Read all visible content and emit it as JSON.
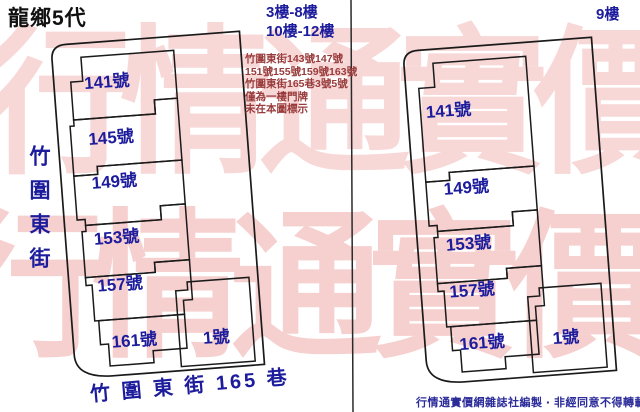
{
  "title": "龍鄉5代",
  "watermark": {
    "text": "行情通實價網",
    "color": "#f8d7d7"
  },
  "colors": {
    "label_navy": "#1c1c9c",
    "note_red": "#993b3b",
    "outline_black": "#1a1a1a",
    "credit_blue": "#2b2b9a"
  },
  "left_map": {
    "floors_line1": "3樓-8樓",
    "floors_line2": "10樓-12樓",
    "street_left_vertical": "竹圍東街",
    "street_bottom": "竹 圍 東 街 165 巷",
    "units": [
      "141號",
      "145號",
      "149號",
      "153號",
      "157號",
      "161號",
      "1號"
    ]
  },
  "right_map": {
    "floors": "9樓",
    "units": [
      "141號",
      "149號",
      "153號",
      "157號",
      "161號",
      "1號"
    ]
  },
  "notes": {
    "lines": [
      "竹圍東街143號147號",
      "151號155號159號163號",
      "竹圍東街165巷3號5號",
      "僅為一樓門牌",
      "未在本圖標示"
    ]
  },
  "credit": "行情通實價網雜誌社編製 ‧ 非經同意不得轉載"
}
